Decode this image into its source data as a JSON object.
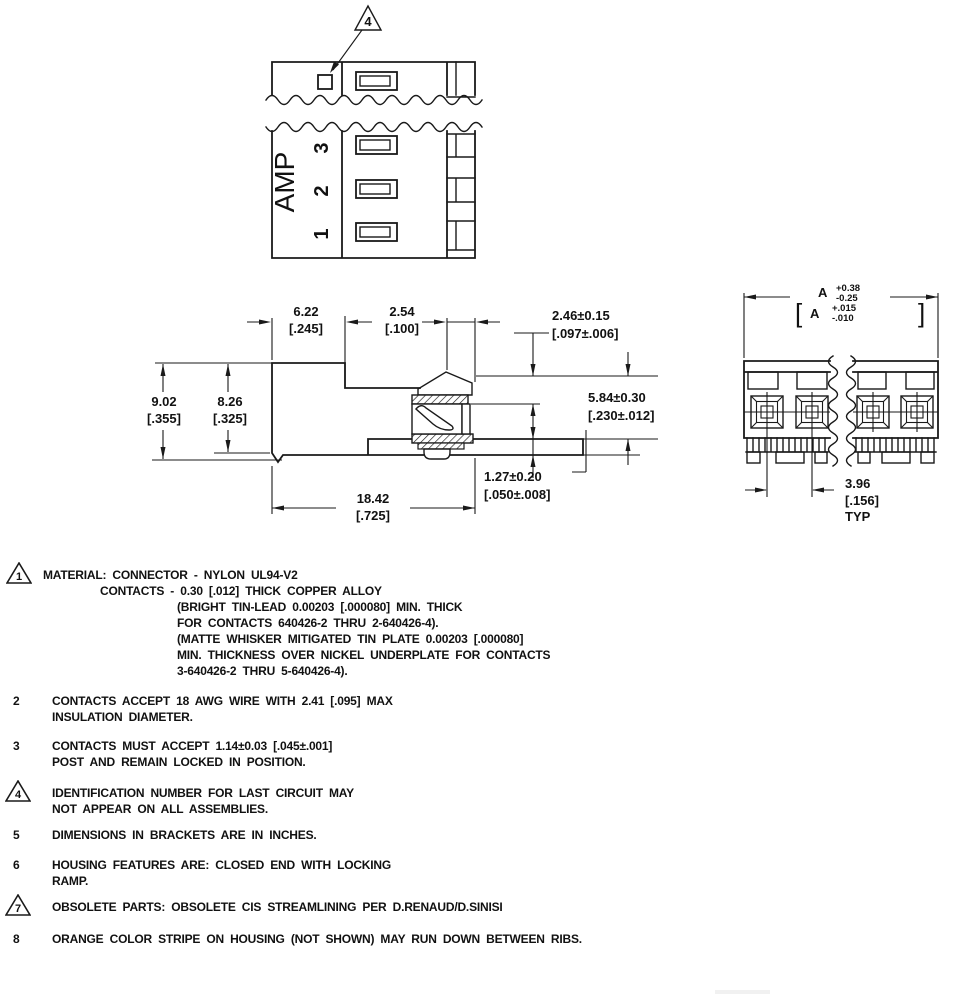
{
  "colors": {
    "ink": "#1a1a1a",
    "paper": "#ffffff"
  },
  "top_view": {
    "callout": "4",
    "brand": "AMP",
    "c3": "3",
    "c2": "2",
    "c1": "1"
  },
  "side": {
    "d622mm": "6.22",
    "d622in": "[.245]",
    "d254mm": "2.54",
    "d254in": "[.100]",
    "d246mm": "2.46±0.15",
    "d246in": "[.097±.006]",
    "d902mm": "9.02",
    "d902in": "[.355]",
    "d826mm": "8.26",
    "d826in": "[.325]",
    "d584mm": "5.84±0.30",
    "d584in": "[.230±.012]",
    "d127mm": "1.27±0.20",
    "d127in": "[.050±.008]",
    "d1842mm": "18.42",
    "d1842in": "[.725]"
  },
  "end": {
    "a": "A",
    "aplus": "+0.38",
    "aminus": "-0.25",
    "lb": "[",
    "ain": "A",
    "ainplus": "+.015",
    "ainminus": "-.010",
    "rb": "]",
    "d396mm": "3.96",
    "d396in": "[.156]",
    "typ": "TYP"
  },
  "notes": {
    "n1": {
      "num": "1",
      "l1": "MATERIAL: CONNECTOR - NYLON UL94-V2",
      "l2": "CONTACTS - 0.30 [.012] THICK COPPER ALLOY",
      "l3": "(BRIGHT TIN-LEAD 0.00203 [.000080] MIN. THICK",
      "l4": "FOR CONTACTS 640426-2 THRU 2-640426-4).",
      "l5": "(MATTE WHISKER MITIGATED TIN PLATE 0.00203 [.000080]",
      "l6": "MIN. THICKNESS OVER NICKEL UNDERPLATE FOR CONTACTS",
      "l7": "3-640426-2 THRU 5-640426-4)."
    },
    "n2": {
      "num": "2",
      "l1": "CONTACTS ACCEPT 18 AWG WIRE WITH 2.41 [.095] MAX",
      "l2": "INSULATION DIAMETER."
    },
    "n3": {
      "num": "3",
      "l1": "CONTACTS MUST ACCEPT 1.14±0.03 [.045±.001]",
      "l2": "POST AND REMAIN LOCKED IN POSITION."
    },
    "n4": {
      "num": "4",
      "l1": "IDENTIFICATION NUMBER FOR LAST CIRCUIT MAY",
      "l2": "NOT APPEAR ON ALL ASSEMBLIES."
    },
    "n5": {
      "num": "5",
      "l1": "DIMENSIONS IN BRACKETS ARE IN INCHES."
    },
    "n6": {
      "num": "6",
      "l1": "HOUSING FEATURES ARE: CLOSED END WITH LOCKING",
      "l2": "RAMP."
    },
    "n7": {
      "num": "7",
      "l1": "OBSOLETE PARTS: OBSOLETE CIS STREAMLINING PER D.RENAUD/D.SINISI"
    },
    "n8": {
      "num": "8",
      "l1": "ORANGE COLOR STRIPE ON HOUSING (NOT SHOWN) MAY RUN DOWN BETWEEN RIBS."
    }
  }
}
